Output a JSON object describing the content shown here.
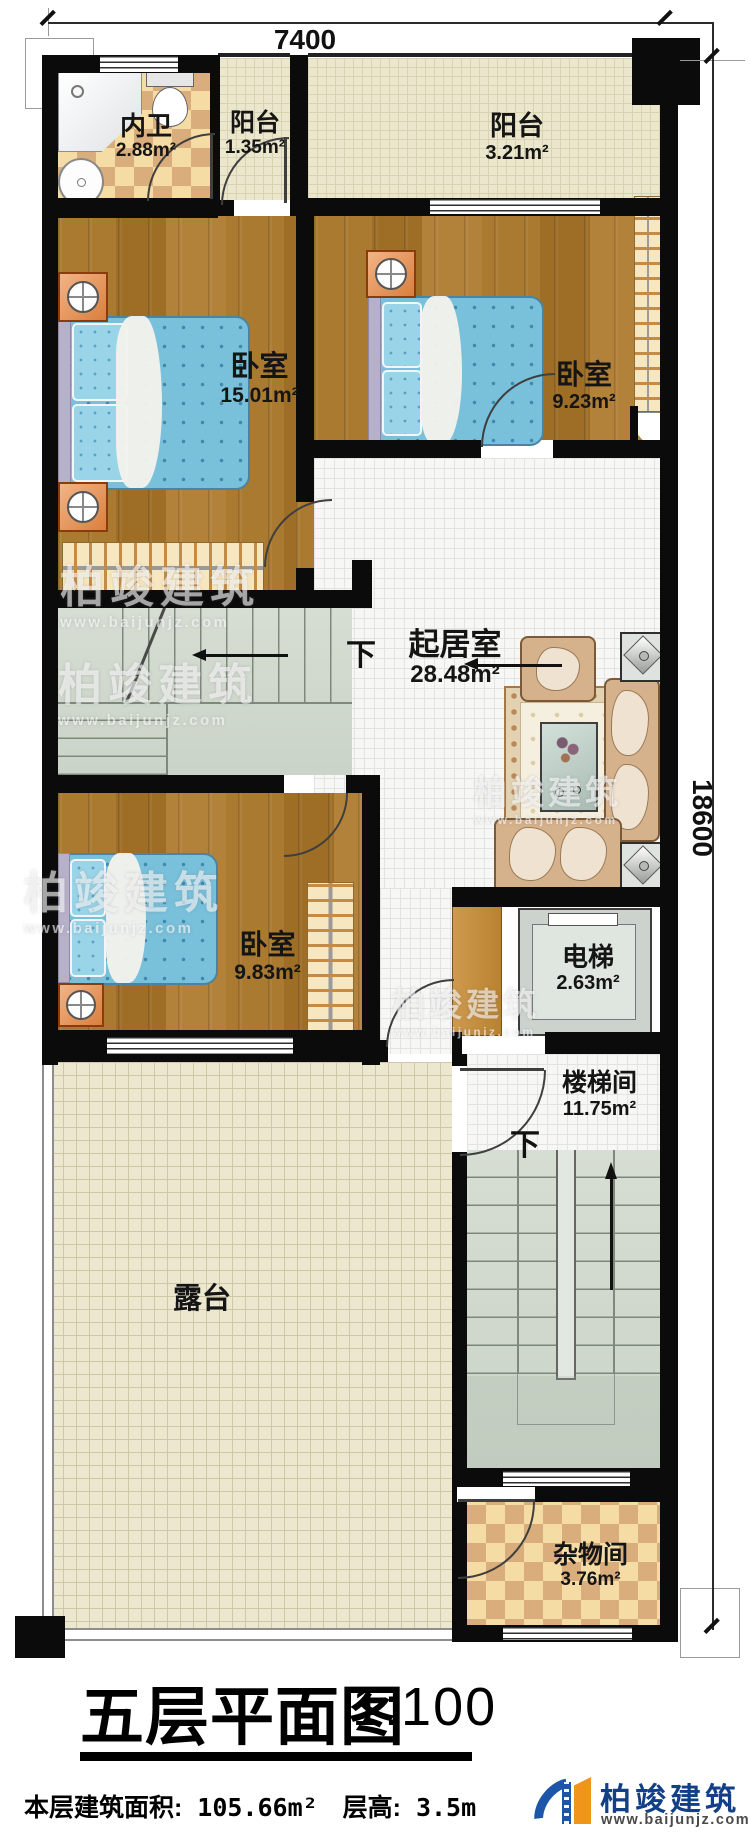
{
  "dimensions": {
    "width_top": "7400",
    "height_right": "18600"
  },
  "rooms": {
    "bathroom": {
      "name": "内卫",
      "area": "2.88m²"
    },
    "balcony_small": {
      "name": "阳台",
      "area": "1.35m²"
    },
    "balcony_large": {
      "name": "阳台",
      "area": "3.21m²"
    },
    "bedroom_master": {
      "name": "卧室",
      "area": "15.01m²"
    },
    "bedroom_east": {
      "name": "卧室",
      "area": "9.23m²"
    },
    "living_room": {
      "name": "起居室",
      "area": "28.48m²"
    },
    "bedroom_south": {
      "name": "卧室",
      "area": "9.83m²"
    },
    "elevator": {
      "name": "电梯",
      "area": "2.63m²"
    },
    "stair_hall": {
      "name": "楼梯间",
      "area": "11.75m²"
    },
    "terrace": {
      "name": "露台"
    },
    "storage": {
      "name": "杂物间",
      "area": "3.76m²"
    }
  },
  "labels": {
    "down_living": "下",
    "down_stairhall": "下"
  },
  "title": {
    "text": "五层平面图",
    "scale": "1:100"
  },
  "footer": {
    "area_label": "本层建筑面积:",
    "area_value": "105.66m²",
    "height_label": "层高:",
    "height_value": "3.5m"
  },
  "brand": {
    "name": "柏竣建筑",
    "url": "www.baijunjz.com"
  },
  "watermark": {
    "name": "柏竣建筑",
    "url": "www.baijunjz.com"
  }
}
